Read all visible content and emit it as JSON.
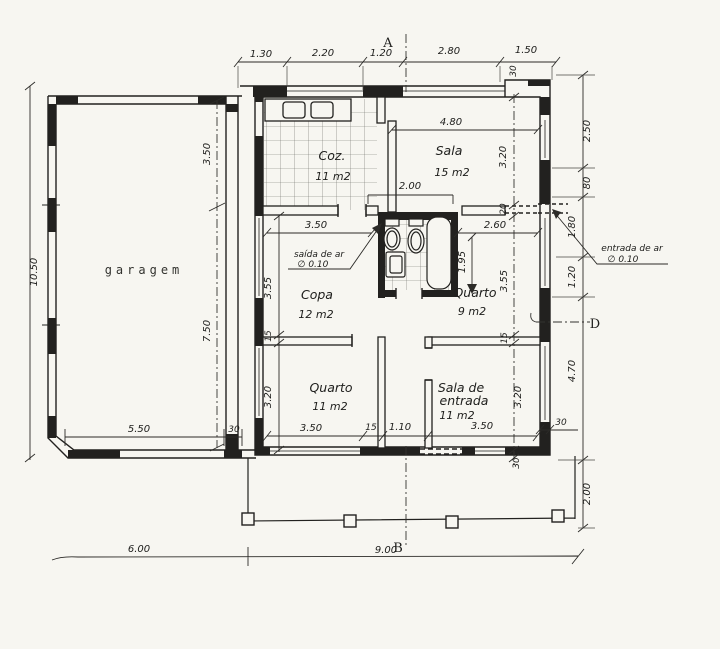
{
  "page": {
    "paper_color": "#f7f6f1",
    "ink_color": "#22211f"
  },
  "plan": {
    "rooms": {
      "garage": {
        "label": "garagem"
      },
      "kitchen": {
        "label": "Coz.",
        "area": "11 m2"
      },
      "living": {
        "label": "Sala",
        "area": "15 m2"
      },
      "dining": {
        "label": "Copa",
        "area": "12 m2"
      },
      "bedroom_small": {
        "label": "Quarto",
        "area": "9 m2"
      },
      "bedroom_large": {
        "label": "Quarto",
        "area": "11 m2"
      },
      "entry": {
        "label1": "Sala de",
        "label2": "entrada",
        "area": "11 m2"
      }
    },
    "markers": {
      "a": "A",
      "b": "B",
      "d": "D"
    },
    "annotations": {
      "air_outlet": {
        "text": "saída de ar",
        "size": "∅ 0.10"
      },
      "air_inlet": {
        "text": "entrada de ar",
        "size": "∅ 0.10"
      }
    },
    "dimensions": {
      "top": {
        "d1": "1.30",
        "d2": "2.20",
        "d3": "1.20",
        "d4": "2.80",
        "d5": "1.50",
        "wall": "30"
      },
      "right_outer": {
        "d1": "2.50",
        "d2": "80",
        "d3": "1.80",
        "d4": "1.20",
        "d5": "4.70",
        "d6": "2.00"
      },
      "right_inner": {
        "d1": "3.20",
        "d2": "20",
        "d3": "3.55",
        "d4": "15",
        "d5": "3.20",
        "d6": "30"
      },
      "right_wall": {
        "w": "30"
      },
      "left": {
        "total": "10.50"
      },
      "left_inner": {
        "d1": "3.55",
        "d2": "15",
        "d3": "3.20"
      },
      "garage": {
        "v1": "3.50",
        "v2": "7.50",
        "w": "5.50",
        "wall": "30"
      },
      "living": {
        "w": "4.80",
        "opening": "2.00"
      },
      "dining": {
        "w": "3.50"
      },
      "bedroom_small": {
        "w": "2.60",
        "bath": "1.95"
      },
      "bottom": {
        "w1": "3.50",
        "wall": "15",
        "corridor": "1.10",
        "w2": "3.50"
      },
      "site": {
        "left": "6.00",
        "right": "9.00"
      }
    }
  }
}
